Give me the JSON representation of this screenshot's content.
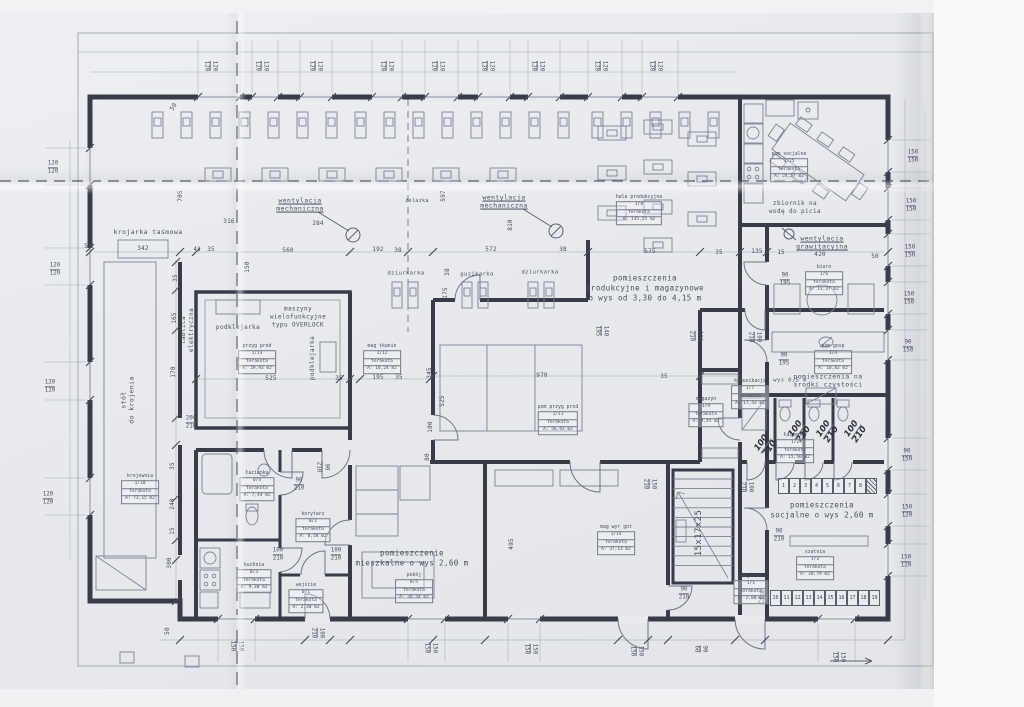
{
  "document": {
    "kind": "architectural floor plan (scanned blueprint)",
    "language": "Polish"
  },
  "palette": {
    "paper": "#e8eaed",
    "ink": "#8a8fa0",
    "wall": "#383c48",
    "text": "#4a4f5d",
    "dash": "#41454f",
    "handwriting": "#2d313c"
  },
  "plan": {
    "labels": [
      {
        "t": "wentylacja\nmechaniczna",
        "x": 300,
        "y": 205,
        "c": "u"
      },
      {
        "t": "wentylacja\nmechaniczna",
        "x": 504,
        "y": 202,
        "c": "u"
      },
      {
        "t": "wentylacja\ngrawitacyjna",
        "x": 822,
        "y": 243,
        "c": "u"
      },
      {
        "t": "pomieszczenia\nprodukcyjne i magazynowe\no wys od 3,30 do 4,15 m",
        "x": 645,
        "y": 288,
        "s": 7.5
      },
      {
        "t": "pomieszczenie\nmieszkalne o wys 2,60 m",
        "x": 412,
        "y": 558,
        "s": 7.5
      },
      {
        "t": "pomieszczenia\nsocjalne o wys 2,60 m",
        "x": 822,
        "y": 510,
        "s": 7.5
      },
      {
        "t": "pomieszczenia na\nśrodki czystości",
        "x": 828,
        "y": 381,
        "s": 6.5
      },
      {
        "t": "zbiornik na\nwodę do picia",
        "x": 795,
        "y": 208,
        "s": 6
      },
      {
        "t": "krojarka taśmowa",
        "x": 148,
        "y": 232,
        "s": 6.5
      },
      {
        "t": "stół\ndo krojenia",
        "x": 128,
        "y": 400,
        "r": -90,
        "s": 6.5
      },
      {
        "t": "tablica\nelektryczna",
        "x": 188,
        "y": 330,
        "r": -90,
        "s": 6
      },
      {
        "t": "maszyny\nwielofunkcyjne\ntypu OVERLOCK",
        "x": 298,
        "y": 317,
        "s": 6
      },
      {
        "t": "podklejarka",
        "x": 238,
        "y": 328,
        "s": 6
      },
      {
        "t": "podklejarka",
        "x": 313,
        "y": 358,
        "r": -90,
        "s": 6
      },
      {
        "t": "dziurkarka",
        "x": 406,
        "y": 274,
        "s": 5.5
      },
      {
        "t": "guzikarka",
        "x": 477,
        "y": 275,
        "s": 5.5
      },
      {
        "t": "dziurkarka",
        "x": 540,
        "y": 273,
        "s": 5.5
      },
      {
        "t": "żelazka",
        "x": 417,
        "y": 201,
        "s": 5
      },
      {
        "t": "15x17x25",
        "x": 700,
        "y": 533,
        "r": -90,
        "s": 9
      },
      {
        "t": "wys 0,5 m",
        "x": 790,
        "y": 381,
        "s": 5.5
      }
    ],
    "dim_singles": [
      [
        "705",
        181,
        196,
        -90
      ],
      [
        "597",
        444,
        196,
        -90
      ],
      [
        "810",
        511,
        225,
        -90
      ],
      [
        "316",
        229,
        222,
        0
      ],
      [
        "284",
        318,
        224,
        0
      ],
      [
        "50",
        88,
        247,
        0
      ],
      [
        "342",
        143,
        249,
        0
      ],
      [
        "43",
        197,
        250,
        0
      ],
      [
        "35",
        211,
        250,
        0
      ],
      [
        "560",
        288,
        251,
        0
      ],
      [
        "192",
        378,
        250,
        0
      ],
      [
        "38",
        398,
        251,
        0
      ],
      [
        "572",
        491,
        250,
        0
      ],
      [
        "38",
        563,
        250,
        0
      ],
      [
        "575",
        650,
        252,
        0
      ],
      [
        "35",
        719,
        253,
        0
      ],
      [
        "135",
        757,
        252,
        0
      ],
      [
        "15",
        781,
        253,
        0
      ],
      [
        "420",
        820,
        255,
        0
      ],
      [
        "50",
        875,
        257,
        0
      ],
      [
        "150",
        248,
        267,
        -90
      ],
      [
        "35",
        176,
        278,
        -90
      ],
      [
        "165",
        175,
        318,
        -90
      ],
      [
        "170",
        174,
        372,
        -90
      ],
      [
        "35",
        173,
        466,
        -90
      ],
      [
        "240",
        173,
        504,
        -90
      ],
      [
        "15",
        173,
        531,
        -90
      ],
      [
        "300",
        170,
        563,
        -90
      ],
      [
        "525",
        271,
        379,
        0
      ],
      [
        "35",
        339,
        379,
        0
      ],
      [
        "195",
        378,
        378,
        0
      ],
      [
        "35",
        399,
        378,
        0
      ],
      [
        "970",
        542,
        376,
        0
      ],
      [
        "35",
        664,
        377,
        0
      ],
      [
        "345",
        430,
        373,
        -90
      ],
      [
        "525",
        443,
        401,
        -90
      ],
      [
        "100",
        431,
        427,
        -90
      ],
      [
        "80",
        428,
        457,
        -90
      ],
      [
        "175",
        446,
        293,
        -90
      ],
      [
        "38",
        448,
        272,
        -90
      ],
      [
        "495",
        512,
        544,
        -90
      ],
      [
        "50",
        168,
        631,
        -90
      ],
      [
        "50",
        174,
        107,
        -60
      ]
    ],
    "dim_pairs": [
      {
        "a": "120",
        "b": "120",
        "x": 210,
        "y": 66,
        "r": 90
      },
      {
        "a": "120",
        "b": "120",
        "x": 261,
        "y": 66,
        "r": 90
      },
      {
        "a": "120",
        "b": "120",
        "x": 315,
        "y": 66,
        "r": 90
      },
      {
        "a": "120",
        "b": "120",
        "x": 386,
        "y": 66,
        "r": 90
      },
      {
        "a": "120",
        "b": "120",
        "x": 437,
        "y": 66,
        "r": 90
      },
      {
        "a": "120",
        "b": "120",
        "x": 487,
        "y": 66,
        "r": 90
      },
      {
        "a": "120",
        "b": "120",
        "x": 537,
        "y": 66,
        "r": 90
      },
      {
        "a": "120",
        "b": "120",
        "x": 600,
        "y": 66,
        "r": 90
      },
      {
        "a": "120",
        "b": "120",
        "x": 655,
        "y": 66,
        "r": 90
      },
      {
        "a": "120",
        "b": "120",
        "x": 53,
        "y": 168,
        "r": 0
      },
      {
        "a": "120",
        "b": "120",
        "x": 55,
        "y": 270,
        "r": 0
      },
      {
        "a": "120",
        "b": "120",
        "x": 50,
        "y": 387,
        "r": 0
      },
      {
        "a": "120",
        "b": "120",
        "x": 48,
        "y": 499,
        "r": 0
      },
      {
        "a": "150",
        "b": "150",
        "x": 913,
        "y": 157,
        "r": 0
      },
      {
        "a": "150",
        "b": "150",
        "x": 911,
        "y": 206,
        "r": 0
      },
      {
        "a": "150",
        "b": "150",
        "x": 910,
        "y": 252,
        "r": 0
      },
      {
        "a": "150",
        "b": "150",
        "x": 909,
        "y": 299,
        "r": 0
      },
      {
        "a": "90",
        "b": "150",
        "x": 908,
        "y": 347,
        "r": 0
      },
      {
        "a": "90",
        "b": "150",
        "x": 907,
        "y": 456,
        "r": 0
      },
      {
        "a": "150",
        "b": "120",
        "x": 907,
        "y": 512,
        "r": 0
      },
      {
        "a": "150",
        "b": "120",
        "x": 906,
        "y": 562,
        "r": 0
      },
      {
        "a": "150",
        "b": "150",
        "x": 236,
        "y": 646,
        "r": 90
      },
      {
        "a": "100",
        "b": "210",
        "x": 317,
        "y": 633,
        "r": 90
      },
      {
        "a": "150",
        "b": "150",
        "x": 430,
        "y": 648,
        "r": 90
      },
      {
        "a": "150",
        "b": "150",
        "x": 530,
        "y": 649,
        "r": 90
      },
      {
        "a": "150",
        "b": "150",
        "x": 636,
        "y": 651,
        "r": 90
      },
      {
        "a": "90",
        "b": "60",
        "x": 700,
        "y": 649,
        "r": 90
      },
      {
        "a": "150",
        "b": "150",
        "x": 838,
        "y": 657,
        "r": 90
      },
      {
        "a": "90",
        "b": "195",
        "x": 785,
        "y": 280,
        "r": 0
      },
      {
        "a": "90",
        "b": "195",
        "x": 784,
        "y": 360,
        "r": 0
      },
      {
        "a": "90",
        "b": "210",
        "x": 299,
        "y": 485,
        "r": 0
      },
      {
        "a": "100",
        "b": "210",
        "x": 278,
        "y": 555,
        "r": 0
      },
      {
        "a": "100",
        "b": "210",
        "x": 336,
        "y": 555,
        "r": 0
      },
      {
        "a": "200",
        "b": "210",
        "x": 191,
        "y": 423,
        "r": 0
      },
      {
        "a": "90",
        "b": "210",
        "x": 779,
        "y": 536,
        "r": 0
      },
      {
        "a": "90",
        "b": "210",
        "x": 684,
        "y": 594,
        "r": 0
      },
      {
        "a": "90",
        "b": "210",
        "x": 763,
        "y": 598,
        "r": 0
      },
      {
        "a": "90",
        "b": "210",
        "x": 322,
        "y": 467,
        "r": 90
      },
      {
        "a": "100",
        "b": "210",
        "x": 695,
        "y": 336,
        "r": 90
      },
      {
        "a": "100",
        "b": "210",
        "x": 754,
        "y": 337,
        "r": 90
      },
      {
        "a": "140",
        "b": "195",
        "x": 601,
        "y": 331,
        "r": 90
      },
      {
        "a": "150",
        "b": "210",
        "x": 649,
        "y": 484,
        "r": 90
      },
      {
        "a": "100",
        "b": "210",
        "x": 746,
        "y": 487,
        "r": 90
      },
      {
        "a": "100",
        "b": "210",
        "x": 766,
        "y": 446,
        "r": -55,
        "h": true
      },
      {
        "a": "100",
        "b": "210",
        "x": 800,
        "y": 432,
        "r": -55,
        "h": true
      },
      {
        "a": "100",
        "b": "210",
        "x": 828,
        "y": 432,
        "r": -55,
        "h": true
      },
      {
        "a": "100",
        "b": "210",
        "x": 856,
        "y": 432,
        "r": -55,
        "h": true
      }
    ],
    "room_tags": [
      {
        "name": "pokój",
        "num": "0/5",
        "mat": "terakota",
        "area": "A: 20,54 m2",
        "x": 414,
        "y": 588
      },
      {
        "name": "łazienka",
        "num": "0/4",
        "mat": "terakota",
        "area": "A: 7,44 m2",
        "x": 257,
        "y": 486
      },
      {
        "name": "korytarz",
        "num": "0/2",
        "mat": "terakota",
        "area": "A: 8,50 m2",
        "x": 313,
        "y": 527
      },
      {
        "name": "kuchnia",
        "num": "0/3",
        "mat": "terakota",
        "area": "A: 9,30 m2",
        "x": 254,
        "y": 578
      },
      {
        "name": "wejście",
        "num": "0/1",
        "mat": "terakota",
        "area": "A: 2,30 m2",
        "x": 306,
        "y": 598
      },
      {
        "name": "przyg prod",
        "num": "1/13",
        "mat": "terakota",
        "area": "A: 29,93 m2",
        "x": 257,
        "y": 359
      },
      {
        "name": "mag tkanin",
        "num": "1/12",
        "mat": "terakota",
        "area": "A: 18,24 m2",
        "x": 382,
        "y": 359
      },
      {
        "name": "krojownia",
        "num": "1/10",
        "mat": "terakota",
        "area": "A: 73,15 m2",
        "x": 140,
        "y": 489
      },
      {
        "name": "pom przyg prod",
        "num": "1/11",
        "mat": "terakota",
        "area": "A: 56,93 m2",
        "x": 558,
        "y": 420
      },
      {
        "name": "hala produkcyjna",
        "num": "1/8",
        "mat": "terakota",
        "area": "A: 135,55 m2",
        "x": 639,
        "y": 210
      },
      {
        "name": "pom socjalne",
        "num": "1/15",
        "mat": "terakota",
        "area": "A: 24,57 m2",
        "x": 789,
        "y": 167
      },
      {
        "name": "magazyn",
        "num": "1/9",
        "mat": "terakota",
        "area": "A: 9,45 m2",
        "x": 706,
        "y": 412
      },
      {
        "name": "komunikacja",
        "num": "1/7",
        "mat": "terakota",
        "area": "A: 17,43 m2",
        "x": 750,
        "y": 394
      },
      {
        "name": "biuro",
        "num": "1/6",
        "mat": "terakota",
        "area": "A: 13,37 m2",
        "x": 824,
        "y": 280
      },
      {
        "name": "pom gosp",
        "num": "1/4",
        "mat": "terakota",
        "area": "A: 10,82 m2",
        "x": 833,
        "y": 359
      },
      {
        "name": "łazienka",
        "num": "1/2",
        "mat": "terakota",
        "area": "A: 15,50 m2",
        "x": 795,
        "y": 448
      },
      {
        "name": "szatnia",
        "num": "1/3",
        "mat": "terakota",
        "area": "A: 20,79 m2",
        "x": 815,
        "y": 565
      },
      {
        "name": "mag wyr got",
        "num": "1/14",
        "mat": "terakota",
        "area": "A: 37,13 m2",
        "x": 616,
        "y": 540
      },
      {
        "name": "wejście",
        "num": "1/1",
        "mat": "terakota",
        "area": "A: 2,80 m2",
        "x": 751,
        "y": 589
      }
    ],
    "lockers": {
      "top": [
        "1",
        "2",
        "3",
        "4",
        "5",
        "6",
        "7",
        "8"
      ],
      "bottom": [
        "10",
        "11",
        "12",
        "13",
        "14",
        "15",
        "16",
        "17",
        "18",
        "19"
      ]
    }
  }
}
